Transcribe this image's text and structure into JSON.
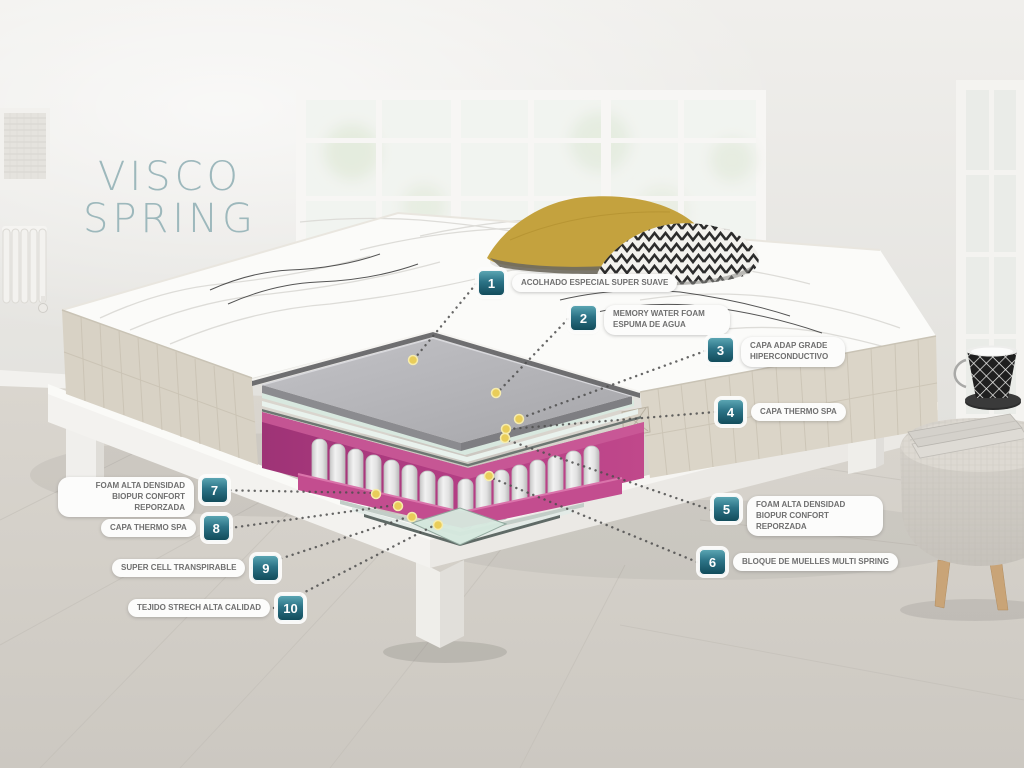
{
  "title": {
    "line1": "VISCO",
    "line2": "SPRING"
  },
  "callouts": [
    {
      "number": "1",
      "text": "ACOLHADO ESPECIAL SUPER SUAVE"
    },
    {
      "number": "2",
      "text": "MEMORY WATER FOAM ESPUMA DE AGUA"
    },
    {
      "number": "3",
      "text": "CAPA ADAP GRADE HIPERCONDUCTIVO"
    },
    {
      "number": "4",
      "text": "CAPA THERMO SPA"
    },
    {
      "number": "5",
      "text": "FOAM ALTA DENSIDAD BIOPUR CONFORT REPORZADA"
    },
    {
      "number": "6",
      "text": "BLOQUE DE MUELLES MULTI SPRING"
    },
    {
      "number": "7",
      "text": "FOAM ALTA DENSIDAD BIOPUR CONFORT REPORZADA"
    },
    {
      "number": "8",
      "text": "CAPA THERMO SPA"
    },
    {
      "number": "9",
      "text": "SUPER CELL TRANSPIRABLE"
    },
    {
      "number": "10",
      "text": "TEJIDO STRECH ALTA CALIDAD"
    }
  ],
  "colors": {
    "badge_gradient_top": "#5aa5b2",
    "badge_gradient_bottom": "#124c5b",
    "title_text": "#9db8bc",
    "foam_magenta": "#b63f87",
    "marker_dot_yellow": "#e9cd5a"
  }
}
